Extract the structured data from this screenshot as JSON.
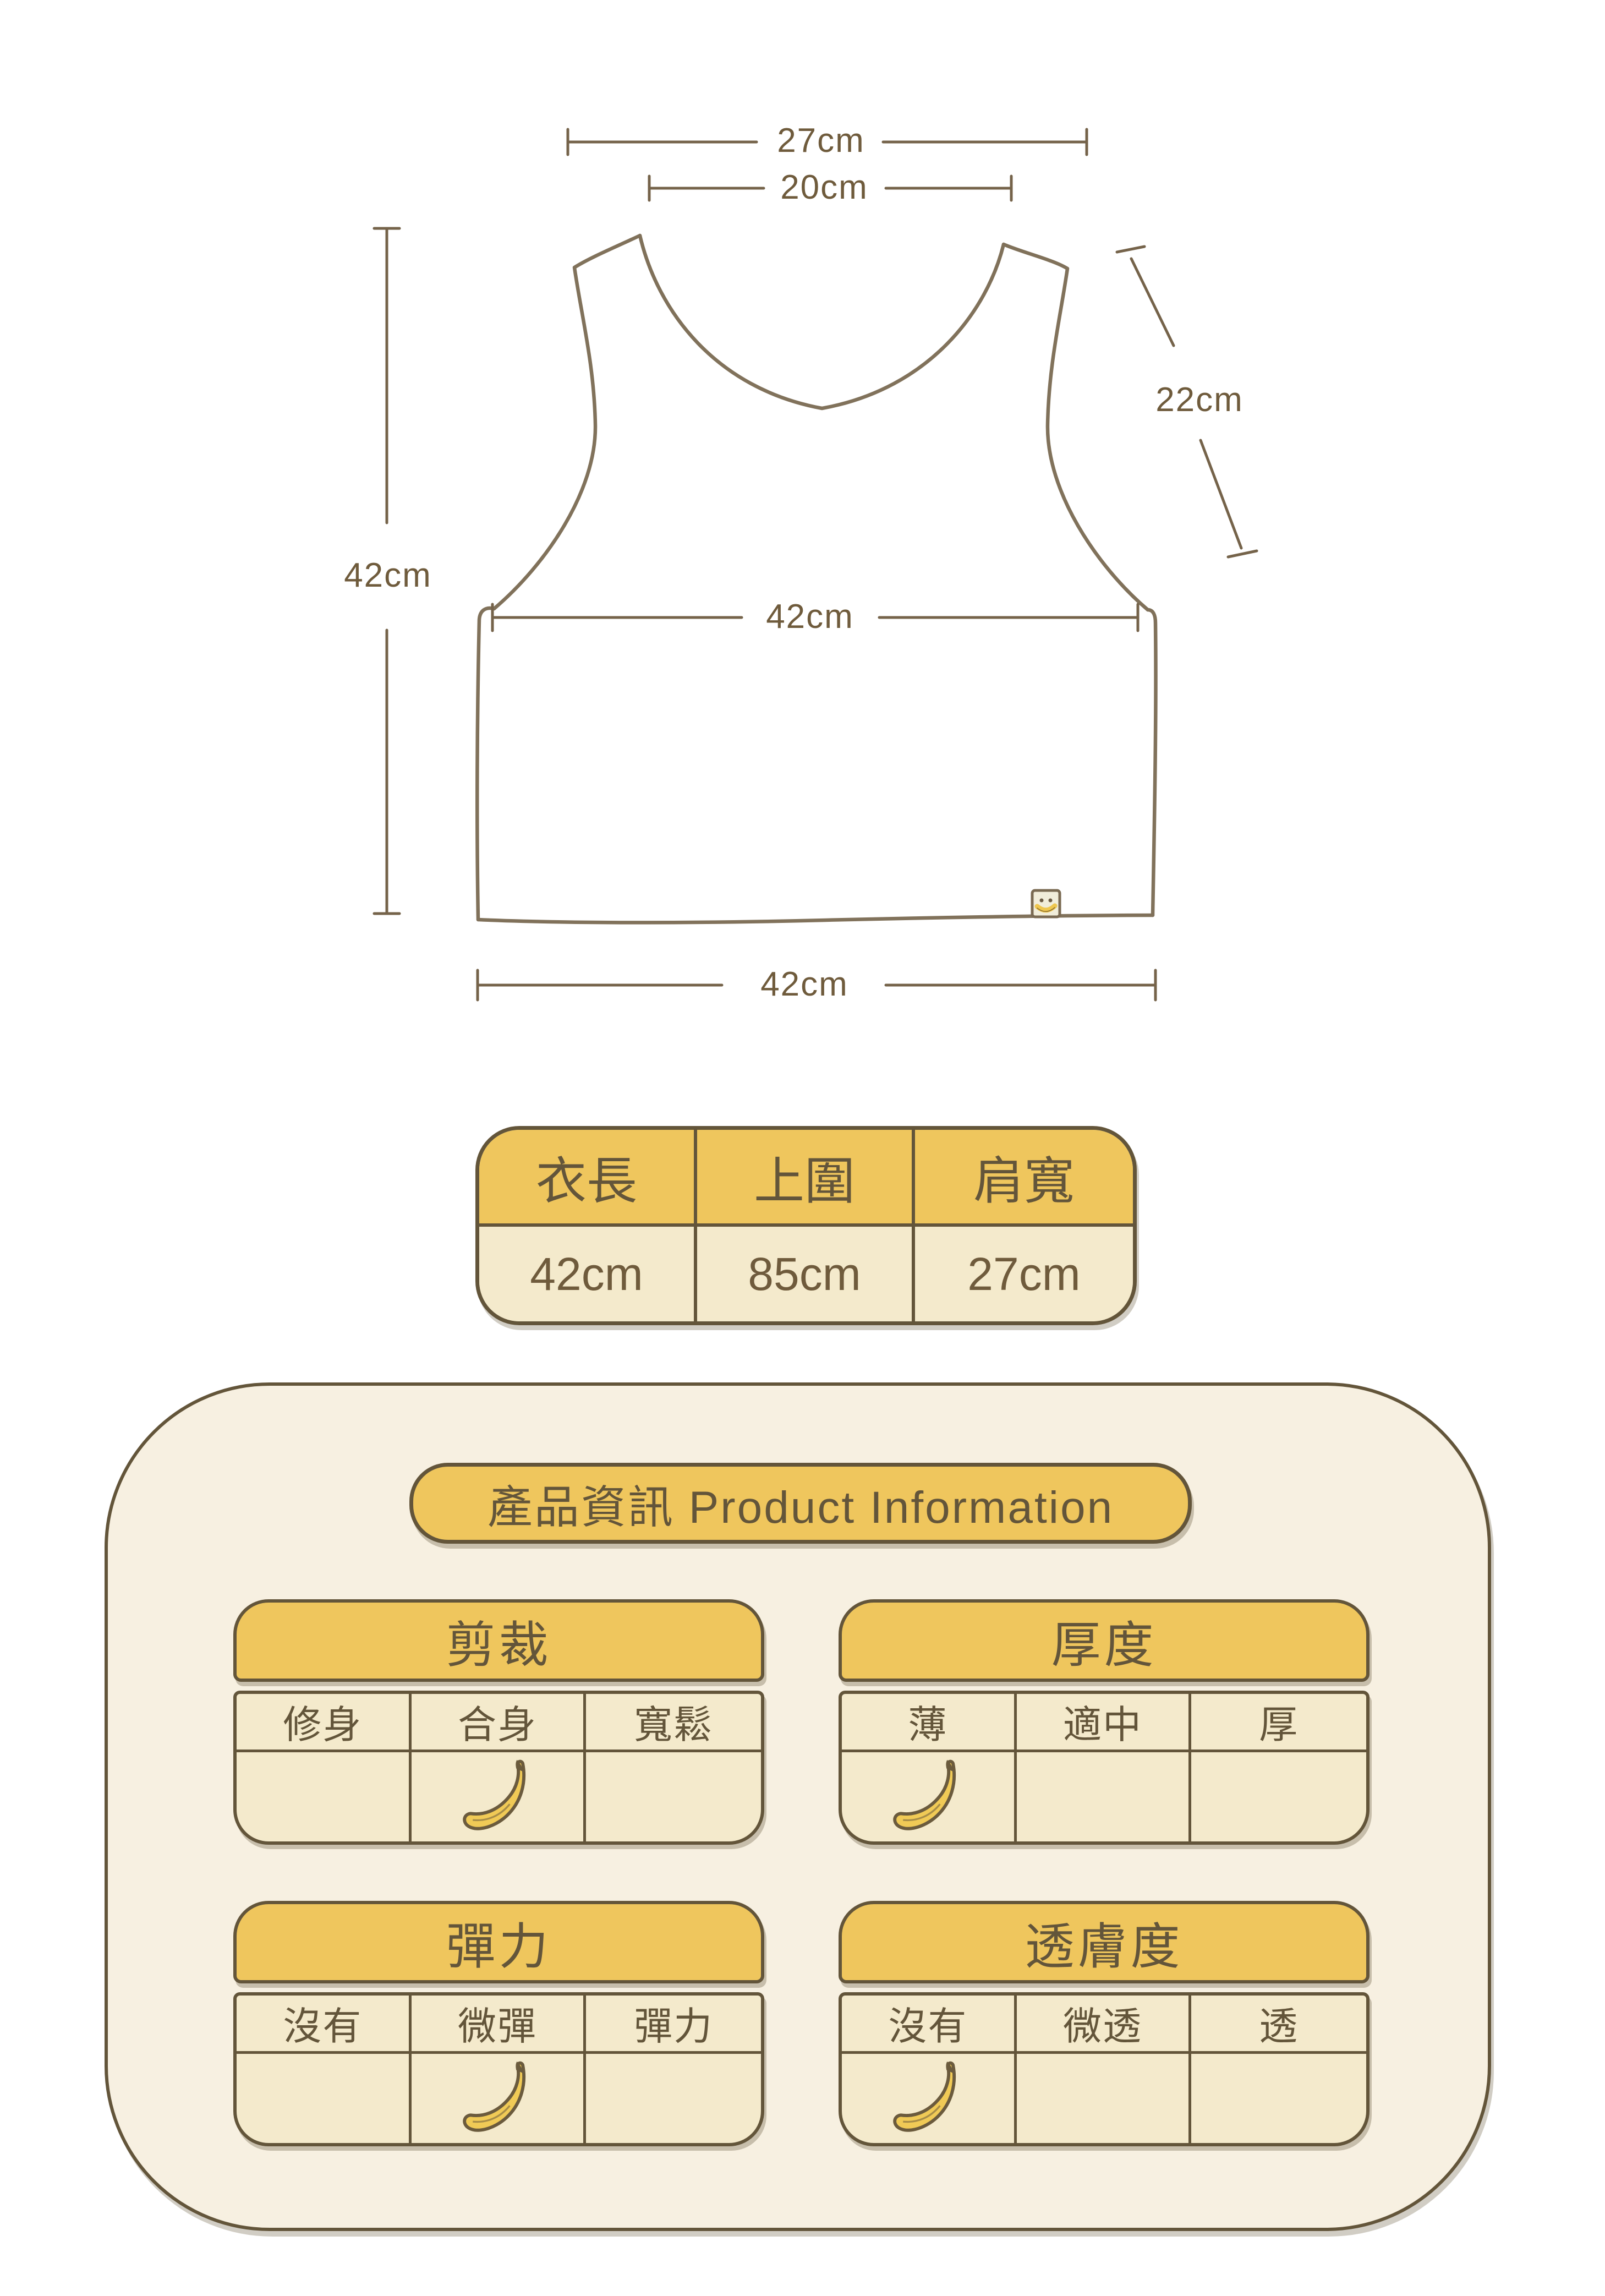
{
  "colors": {
    "accent_yellow": "#EFC65D",
    "cell_cream": "#F4EACC",
    "panel_cream": "#F7F0E1",
    "border_brown": "#63553A",
    "sketch_brown": "#7A6A52",
    "banana_yellow": "#F0CA56"
  },
  "diagram": {
    "labels": {
      "top_width": "27cm",
      "neck_width": "20cm",
      "armhole": "22cm",
      "length": "42cm",
      "chest": "42cm",
      "hem": "42cm"
    }
  },
  "size_table": {
    "columns": [
      {
        "label": "衣長",
        "value": "42cm"
      },
      {
        "label": "上圍",
        "value": "85cm"
      },
      {
        "label": "肩寬",
        "value": "27cm"
      }
    ]
  },
  "product_info": {
    "title": "產品資訊 Product Information",
    "tables": [
      {
        "title": "剪裁",
        "options": [
          "修身",
          "合身",
          "寬鬆"
        ],
        "selected_index": 1
      },
      {
        "title": "厚度",
        "options": [
          "薄",
          "適中",
          "厚"
        ],
        "selected_index": 0
      },
      {
        "title": "彈力",
        "options": [
          "沒有",
          "微彈",
          "彈力"
        ],
        "selected_index": 1
      },
      {
        "title": "透膚度",
        "options": [
          "沒有",
          "微透",
          "透"
        ],
        "selected_index": 0
      }
    ]
  }
}
